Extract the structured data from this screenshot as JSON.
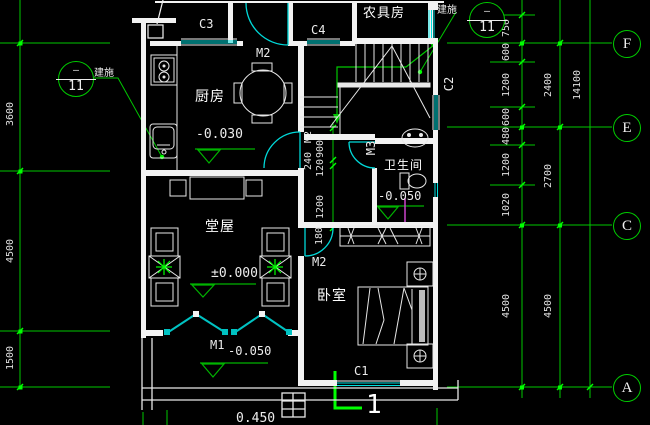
{
  "drawing": {
    "figure_number": "1",
    "outdoor_level": "0.450"
  },
  "colors": {
    "background": "#000000",
    "grid_green": "#00cc00",
    "bright_green": "#00ff00",
    "window_cyan": "#00e0e0",
    "wall_white": "#f2f2f2",
    "pipe_magenta": "#cc44cc"
  },
  "rooms": {
    "kitchen": {
      "name": "厨房",
      "level": "-0.030"
    },
    "hall": {
      "name": "堂屋",
      "level": "±0.000"
    },
    "bedroom": {
      "name": "卧室"
    },
    "bathroom": {
      "name": "卫生间",
      "level": "-0.050"
    },
    "tool_room": {
      "name": "农具房"
    },
    "entrance": {
      "level": "-0.050"
    }
  },
  "openings": {
    "c1": "C1",
    "c2": "C2",
    "c3": "C3",
    "c4": "C4",
    "m1": "M1",
    "m2_top": "M2",
    "m2_kitchen": "M2",
    "m2_bedroom": "M2",
    "m3": "M3"
  },
  "grid_axes": {
    "f": "F",
    "e": "E",
    "c": "C",
    "a": "A"
  },
  "detail_callouts": {
    "left": {
      "tag": "建施",
      "top": "—",
      "sheet": "11"
    },
    "top_right": {
      "tag": "建施",
      "top": "—",
      "sheet": "11"
    }
  },
  "dimensions": {
    "left": [
      "3600",
      "4500",
      "1500"
    ],
    "right_inner": [
      "750",
      "600",
      "1200",
      "600",
      "480",
      "1200",
      "1020",
      "4500"
    ],
    "right_mid": [
      "2400",
      "2700",
      "4500"
    ],
    "right_total": "14100",
    "center_chain": {
      "wall": "240",
      "d900": "900",
      "d120": "120",
      "d1200": "1200",
      "d180": "180"
    }
  }
}
